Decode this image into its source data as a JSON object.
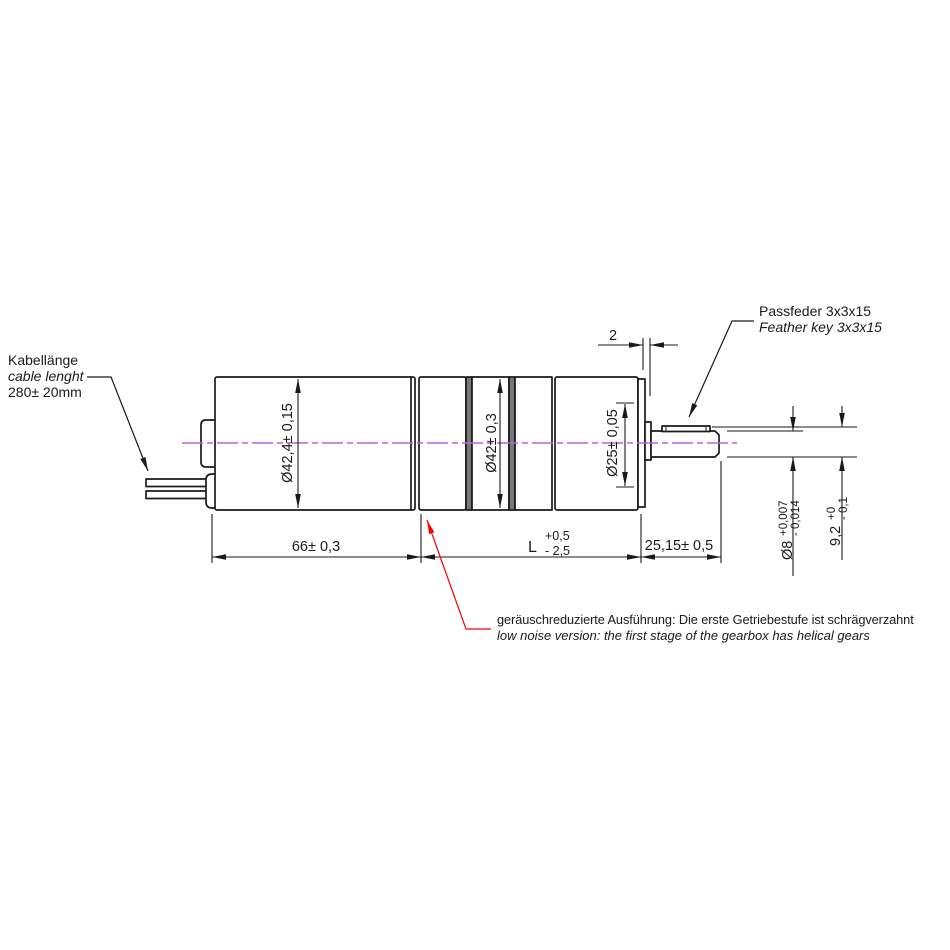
{
  "annotations": {
    "cable": {
      "title_de": "Kabellänge",
      "title_en": "cable lenght",
      "value": "280± 20mm"
    },
    "feather_key": {
      "title_de": "Passfeder 3x3x15",
      "title_en": "Feather key 3x3x15"
    },
    "low_noise": {
      "note_de": "geräuschreduzierte Ausführung: Die erste Getriebestufe ist schrägverzahnt",
      "note_en": "low noise version: the first stage of the gearbox has helical gears"
    }
  },
  "dimensions": {
    "motor_diameter": "Ø42,4± 0,15",
    "gearbox_diameter": "Ø42± 0,3",
    "pilot_diameter": "Ø25± 0,05",
    "motor_length": "66± 0,3",
    "gearbox_length": {
      "nominal": "L",
      "plus": "+0,5",
      "minus": "- 2,5"
    },
    "shaft_length": "25,15± 0,5",
    "collar_width": "2",
    "shaft_diameter": {
      "nominal": "Ø8",
      "plus": "+0,007",
      "minus": "- 0,014"
    },
    "shaft_key_height": {
      "nominal": "9,2",
      "plus": "+0",
      "minus": "- 0,1"
    }
  },
  "colors": {
    "line": "#1a1a1a",
    "centerline": "#bd63cf",
    "annotation": "#ff0000",
    "divider_fill": "#787878"
  }
}
